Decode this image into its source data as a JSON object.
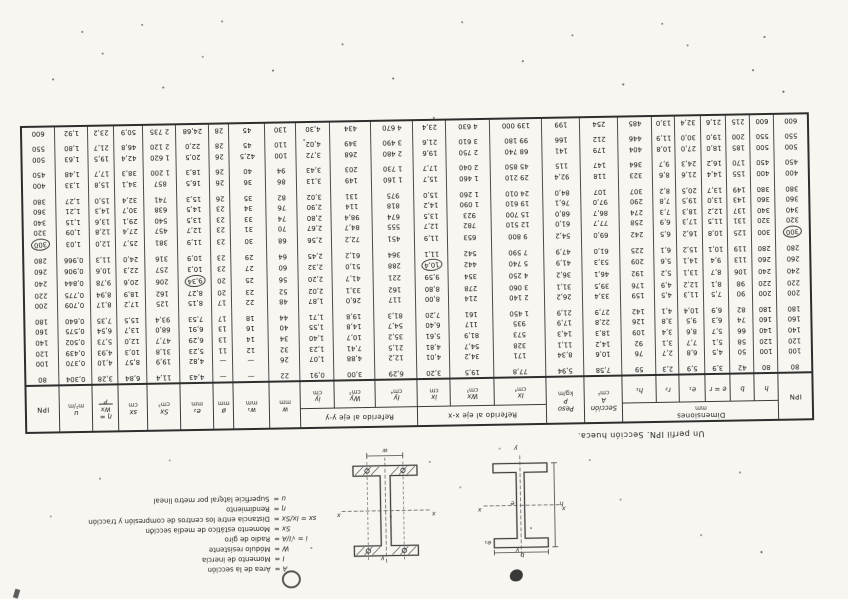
{
  "caption": "Un perfil IPN. Sección hueca.",
  "table": {
    "header": {
      "ipn_left": "IPN",
      "ipn_right": "IPN",
      "dims": "Dimensiones",
      "dims_unit": "mm",
      "sub_h": "h",
      "sub_b": "b",
      "sub_e": "e = r",
      "sub_e1": "e₁",
      "sub_r2": "r₂",
      "sub_h1": "h₁",
      "sec_1": "Sección",
      "sec_2": "A",
      "sec_3": "cm²",
      "peso_1": "Peso",
      "peso_2": "P",
      "peso_3": "kg/m",
      "eje_x": "Referido al eje x-x",
      "eje_y": "Referido al eje y-y",
      "Ix": "Ix",
      "Ix_u": "cm⁴",
      "Wx": "Wx",
      "Wx_u": "cm³",
      "ix": "ix",
      "ix_u": "cm",
      "Iy": "Iy",
      "Iy_u": "cm⁴",
      "Wy": "Wy",
      "Wy_u": "cm³",
      "iy": "iy",
      "iy_u": "cm",
      "w": "w",
      "w_u": "mm",
      "w1": "w₁",
      "w1_u": "mm",
      "dia": "ø",
      "dia_u": "mm",
      "e2": "e₂",
      "e2_u": "mm",
      "Sx": "Sx",
      "Sx_u": "cm³",
      "sx": "sx",
      "sx_u": "cm",
      "eta": "η =",
      "eta_num": "Wx",
      "eta_den": "P",
      "u": "u",
      "u_u": "m²/m"
    },
    "row_groups": [
      [
        [
          "80",
          "80",
          "42",
          "3,9",
          "5,9",
          "2,3",
          "59",
          "7,58",
          "5,94",
          "77,8",
          "19,5",
          "3,20",
          "6,29",
          "3,00",
          "0,91",
          "22",
          "—",
          "—",
          "4,43",
          "11,4",
          "6,84",
          "3,28",
          "0,304",
          "80"
        ]
      ],
      [
        [
          "100",
          "100",
          "50",
          "4,5",
          "6,8",
          "2,7",
          "76",
          "10,6",
          "8,34",
          "171",
          "34,2",
          "4,01",
          "12,2",
          "4,88",
          "1,07",
          "26",
          "—",
          "—",
          "4,82",
          "19,9",
          "8,57",
          "4,10",
          "0,370",
          "100"
        ],
        [
          "120",
          "120",
          "58",
          "5,1",
          "7,7",
          "3,1",
          "92",
          "14,2",
          "11,1",
          "328",
          "54,7",
          "4,81",
          "21,5",
          "7,41",
          "1,23",
          "32",
          "12",
          "11",
          "5,23",
          "31,8",
          "10,3",
          "4,93",
          "0,439",
          "120"
        ],
        [
          "140",
          "140",
          "66",
          "5,7",
          "8,6",
          "3,4",
          "109",
          "18,3",
          "14,3",
          "573",
          "81,9",
          "5,61",
          "35,2",
          "10,7",
          "1,40",
          "34",
          "14",
          "13",
          "6,29",
          "47,7",
          "12,0",
          "5,73",
          "0,502",
          "140"
        ],
        [
          "160",
          "160",
          "74",
          "6,3",
          "9,5",
          "3,8",
          "126",
          "22,8",
          "17,9",
          "935",
          "117",
          "6,40",
          "54,7",
          "14,8",
          "1,55",
          "40",
          "16",
          "13",
          "6,91",
          "68,0",
          "13,7",
          "6,54",
          "0,575",
          "160"
        ],
        [
          "180",
          "180",
          "82",
          "6,9",
          "10,4",
          "4,1",
          "142",
          "27,9",
          "21,9",
          "1 450",
          "161",
          "7,20",
          "81,3",
          "19,8",
          "1,71",
          "44",
          "18",
          "17",
          "7,53",
          "93,4",
          "15,5",
          "7,35",
          "0,640",
          "180"
        ]
      ],
      [
        [
          "200",
          "200",
          "90",
          "7,5",
          "11,3",
          "4,5",
          "159",
          "33,4",
          "26,2",
          "2 140",
          "214",
          "8,00",
          "117",
          "26,0",
          "1,87",
          "48",
          "22",
          "17",
          "8,15",
          "125",
          "17,2",
          "8,17",
          "0,709",
          "200"
        ],
        [
          "220",
          "220",
          "98",
          "8,1",
          "12,2",
          "4,9",
          "176",
          "39,5",
          "31,1",
          "3 060",
          "278",
          "8,80",
          "162",
          "33,1",
          "2,02",
          "52",
          "23",
          "20",
          "8,27",
          "162",
          "18,9",
          "8,94",
          "0,775",
          "220"
        ],
        [
          "240",
          "240",
          "106",
          "8,7",
          "13,1",
          "5,2",
          "192",
          "46,1",
          "36,2",
          "4 250",
          "354",
          "9,59",
          "221",
          "41,7",
          "2,20",
          "56",
          "25",
          "20",
          "9,34",
          "206",
          "20,6",
          "9,78",
          "0,844",
          "240"
        ],
        [
          "260",
          "260",
          "113",
          "9,4",
          "14,1",
          "5,6",
          "209",
          "53,3",
          "41,9",
          "5 740",
          "442",
          "10,4",
          "288",
          "51,0",
          "2,32",
          "60",
          "27",
          "23",
          "10,3",
          "257",
          "22,3",
          "10,6",
          "0,906",
          "260"
        ],
        [
          "280",
          "280",
          "119",
          "10,1",
          "15,2",
          "6,1",
          "225",
          "61,0",
          "47,9",
          "7 590",
          "542",
          "11,1",
          "364",
          "61,2",
          "2,45",
          "64",
          "29",
          "23",
          "10,9",
          "316",
          "24,0",
          "11,3",
          "0,966",
          "280"
        ]
      ],
      [
        [
          "300",
          "300",
          "125",
          "10,8",
          "16,2",
          "6,5",
          "242",
          "69,0",
          "54,2",
          "9 800",
          "653",
          "11,9",
          "451",
          "72,2",
          "2,56",
          "68",
          "30",
          "23",
          "11,9",
          "381",
          "25,7",
          "12,0",
          "1,03",
          "300"
        ],
        [
          "320",
          "320",
          "131",
          "11,5",
          "17,3",
          "6,9",
          "258",
          "77,7",
          "61,0",
          "12 510",
          "782",
          "12,7",
          "555",
          "84,7",
          "2,67",
          "70",
          "31",
          "23",
          "12,7",
          "457",
          "27,4",
          "12,8",
          "1,09",
          "320"
        ],
        [
          "340",
          "340",
          "137",
          "12,2",
          "18,3",
          "7,3",
          "274",
          "86,7",
          "68,0",
          "15 700",
          "923",
          "13,5",
          "674",
          "98,4",
          "2,80",
          "74",
          "33",
          "23",
          "13,5",
          "540",
          "29,1",
          "13,6",
          "1,15",
          "340"
        ],
        [
          "360",
          "360",
          "143",
          "13,0",
          "19,5",
          "7,8",
          "290",
          "97,0",
          "76,1",
          "19 610",
          "1 090",
          "14,2",
          "818",
          "114",
          "2,90",
          "76",
          "34",
          "23",
          "14,5",
          "638",
          "30,7",
          "14,3",
          "1,21",
          "360"
        ],
        [
          "380",
          "380",
          "149",
          "13,7",
          "20,5",
          "8,2",
          "307",
          "107",
          "84,0",
          "24 010",
          "1 260",
          "15,0",
          "975",
          "131",
          "3,02",
          "82",
          "35",
          "26",
          "15,3",
          "741",
          "32,4",
          "15,0",
          "1,27",
          "380"
        ]
      ],
      [
        [
          "400",
          "400",
          "155",
          "14,4",
          "21,6",
          "8,6",
          "323",
          "118",
          "92,4",
          "29 210",
          "1 460",
          "15,7",
          "1 160",
          "149",
          "3,13",
          "86",
          "36",
          "26",
          "16,5",
          "857",
          "34,1",
          "15,8",
          "1,33",
          "400"
        ],
        [
          "450",
          "450",
          "170",
          "16,2",
          "24,3",
          "9,7",
          "364",
          "147",
          "115",
          "45 850",
          "2 040",
          "17,7",
          "1 730",
          "203",
          "3,43",
          "94",
          "40",
          "26",
          "18,3",
          "1 200",
          "38,3",
          "17,7",
          "1,48",
          "450"
        ]
      ],
      [
        [
          "500",
          "500",
          "185",
          "18,0",
          "27,0",
          "10,8",
          "404",
          "179",
          "141",
          "68 740",
          "2 750",
          "19,6",
          "2 480",
          "268",
          "3,72",
          "100",
          "42,5",
          "26",
          "20,5",
          "1 620",
          "42,4",
          "19,5",
          "1,63",
          "500"
        ],
        [
          "550",
          "550",
          "200",
          "19,0",
          "30,0",
          "11,9",
          "446",
          "212",
          "166",
          "99 180",
          "3 610",
          "21,6",
          "3 490",
          "349",
          "4,02",
          "110",
          "45",
          "28",
          "22,0",
          "2 120",
          "46,8",
          "21,7",
          "1,80",
          "550"
        ]
      ],
      [
        [
          "600",
          "600",
          "215",
          "21,6",
          "32,4",
          "13,0",
          "485",
          "254",
          "199",
          "139 000",
          "4 630",
          "23,4",
          "4 670",
          "434",
          "4,30",
          "130",
          "45",
          "28",
          "24,68",
          "2 735",
          "50,9",
          "23,2",
          "1,92",
          "600"
        ]
      ]
    ],
    "circles": [
      {
        "row": "300",
        "col": 0
      },
      {
        "row": "300",
        "col": 23
      },
      {
        "row": "260",
        "col": 11
      },
      {
        "row": "240",
        "col": 18
      }
    ]
  },
  "notes": [
    {
      "s": "A =",
      "t": "Área de la sección"
    },
    {
      "s": "I =",
      "t": "Momento de inercia"
    },
    {
      "s": "W =",
      "t": "Módulo resistente"
    },
    {
      "s": "i = √I/A =",
      "t": "Radio de giro"
    },
    {
      "s": "Sx =",
      "t": "Momento estático de media sección"
    },
    {
      "s": "sx = Ix/Sx =",
      "t": "Distancia entre los centros de compresión y tracción"
    },
    {
      "s": "η =",
      "t": "Rendimiento"
    },
    {
      "s": "u =",
      "t": "Superficie lateral por metro lineal"
    }
  ],
  "diagram_labels": {
    "d1": {
      "b": "b",
      "e1": "e₁",
      "e": "e",
      "h": "h",
      "x": "x",
      "y": "y"
    },
    "d2": {
      "w": "w",
      "x": "x",
      "y": "y"
    }
  }
}
